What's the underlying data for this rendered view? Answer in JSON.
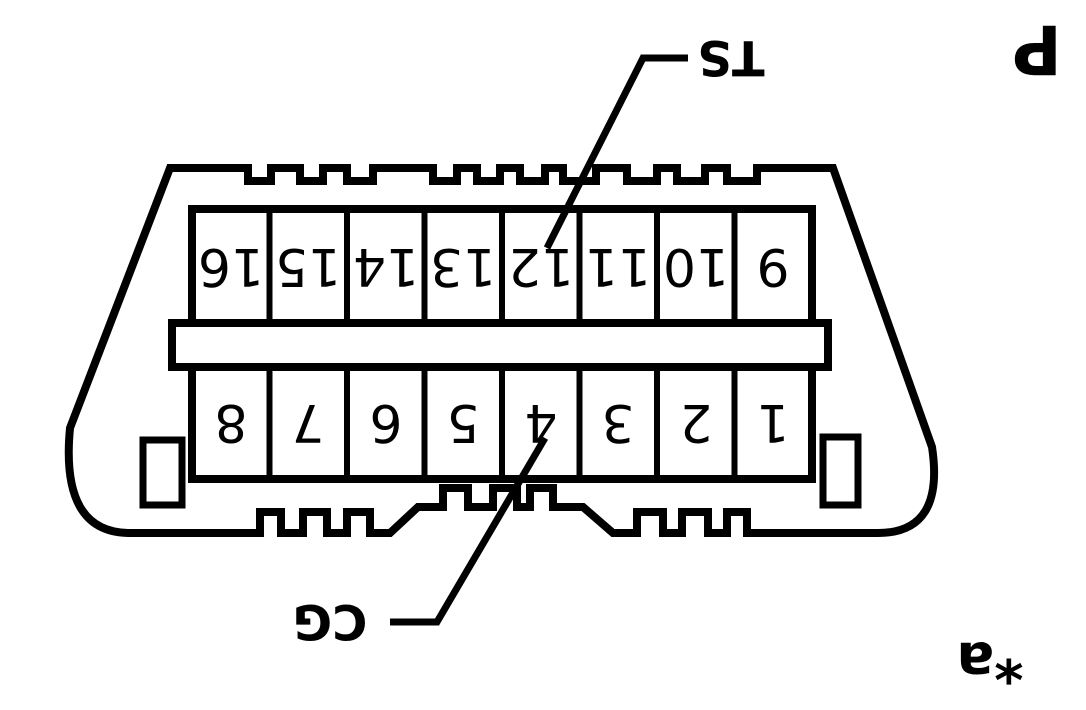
{
  "diagram": {
    "corner_letter": "P",
    "footnote_marker": "*a",
    "callouts": {
      "ts": "TS",
      "cg": "CG"
    },
    "pins": {
      "upper_row": [
        "16",
        "15",
        "14",
        "13",
        "12",
        "11",
        "10",
        "9"
      ],
      "lower_row": [
        "8",
        "7",
        "6",
        "5",
        "4",
        "3",
        "2",
        "1"
      ]
    },
    "colors": {
      "line": "#000000",
      "background": "#ffffff"
    }
  }
}
